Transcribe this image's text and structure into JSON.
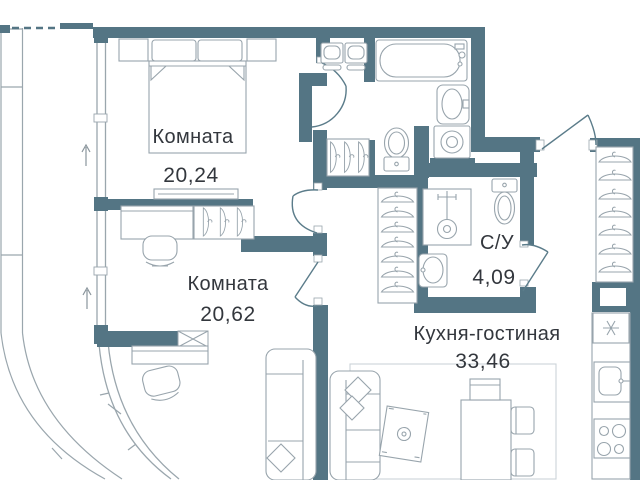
{
  "floor_plan": {
    "rooms": [
      {
        "id": "bedroom-1",
        "label": "Комната",
        "area": "20,24"
      },
      {
        "id": "bedroom-2",
        "label": "Комната",
        "area": "20,62"
      },
      {
        "id": "bathroom-su",
        "label": "С/У",
        "area": "4,09"
      },
      {
        "id": "kitchen-living",
        "label": "Кухня-гостиная",
        "area": "33,46"
      }
    ],
    "colors": {
      "wall": "#547584",
      "furniture_line": "#98a4ac",
      "light_line": "#c7ced4",
      "text": "#33373d",
      "background": "#ffffff"
    }
  }
}
